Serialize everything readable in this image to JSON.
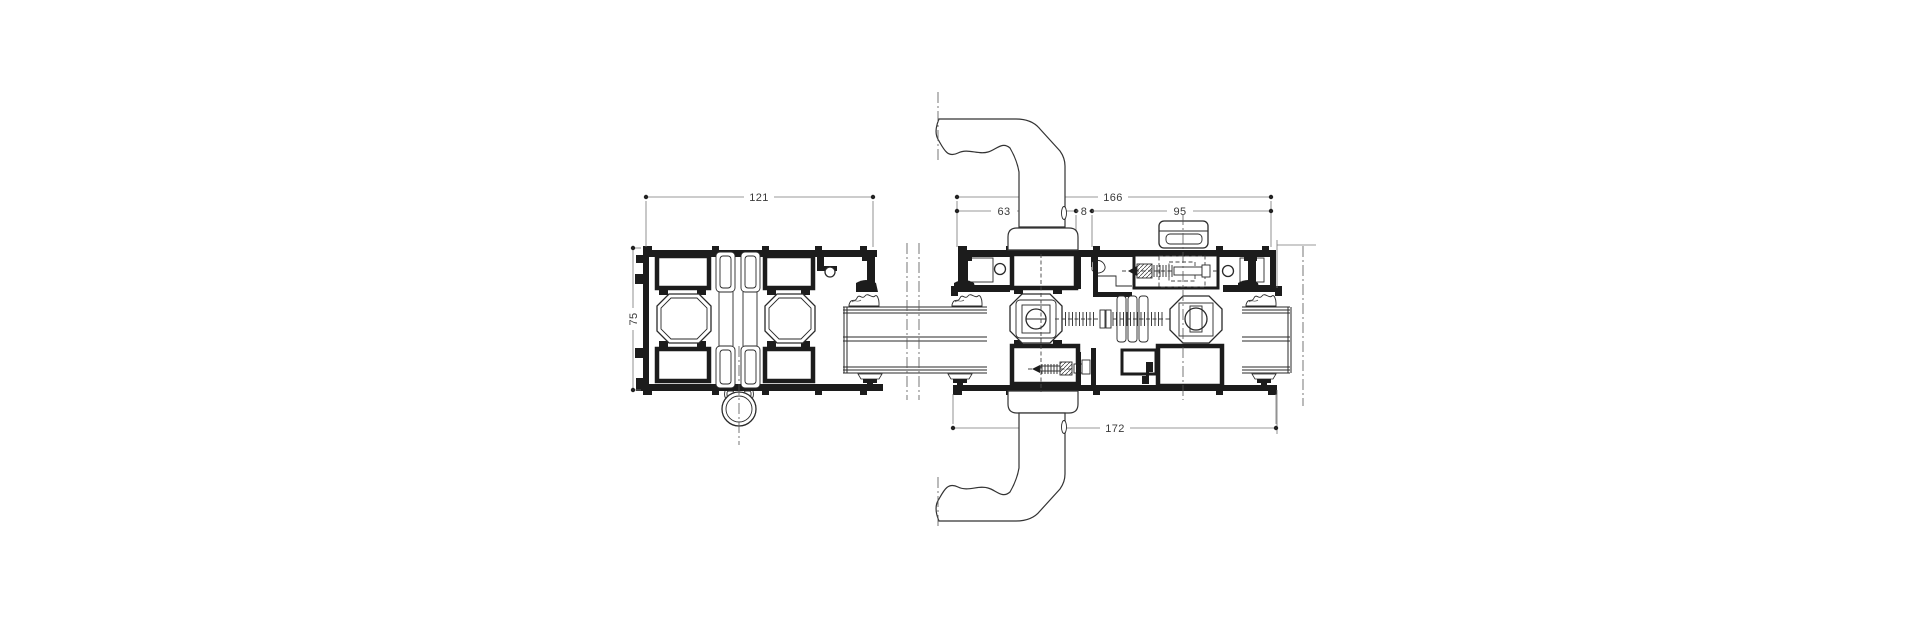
{
  "drawing": {
    "type": "aluminium-window-profile-horizontal-cross-section",
    "dimensions": {
      "left_assembly_width": "121",
      "profile_height": "75",
      "right_assembly_overall": "166",
      "handle_sash_width": "63",
      "sash_gap": "8",
      "lock_sash_width": "95",
      "right_assembly_total_width": "172"
    },
    "colors": {
      "background": "#ffffff",
      "profile_line": "#1c1c1c",
      "thin_line": "#2a2a2a",
      "dimension_line": "#777777",
      "dimension_text": "#3a3a3a"
    }
  }
}
